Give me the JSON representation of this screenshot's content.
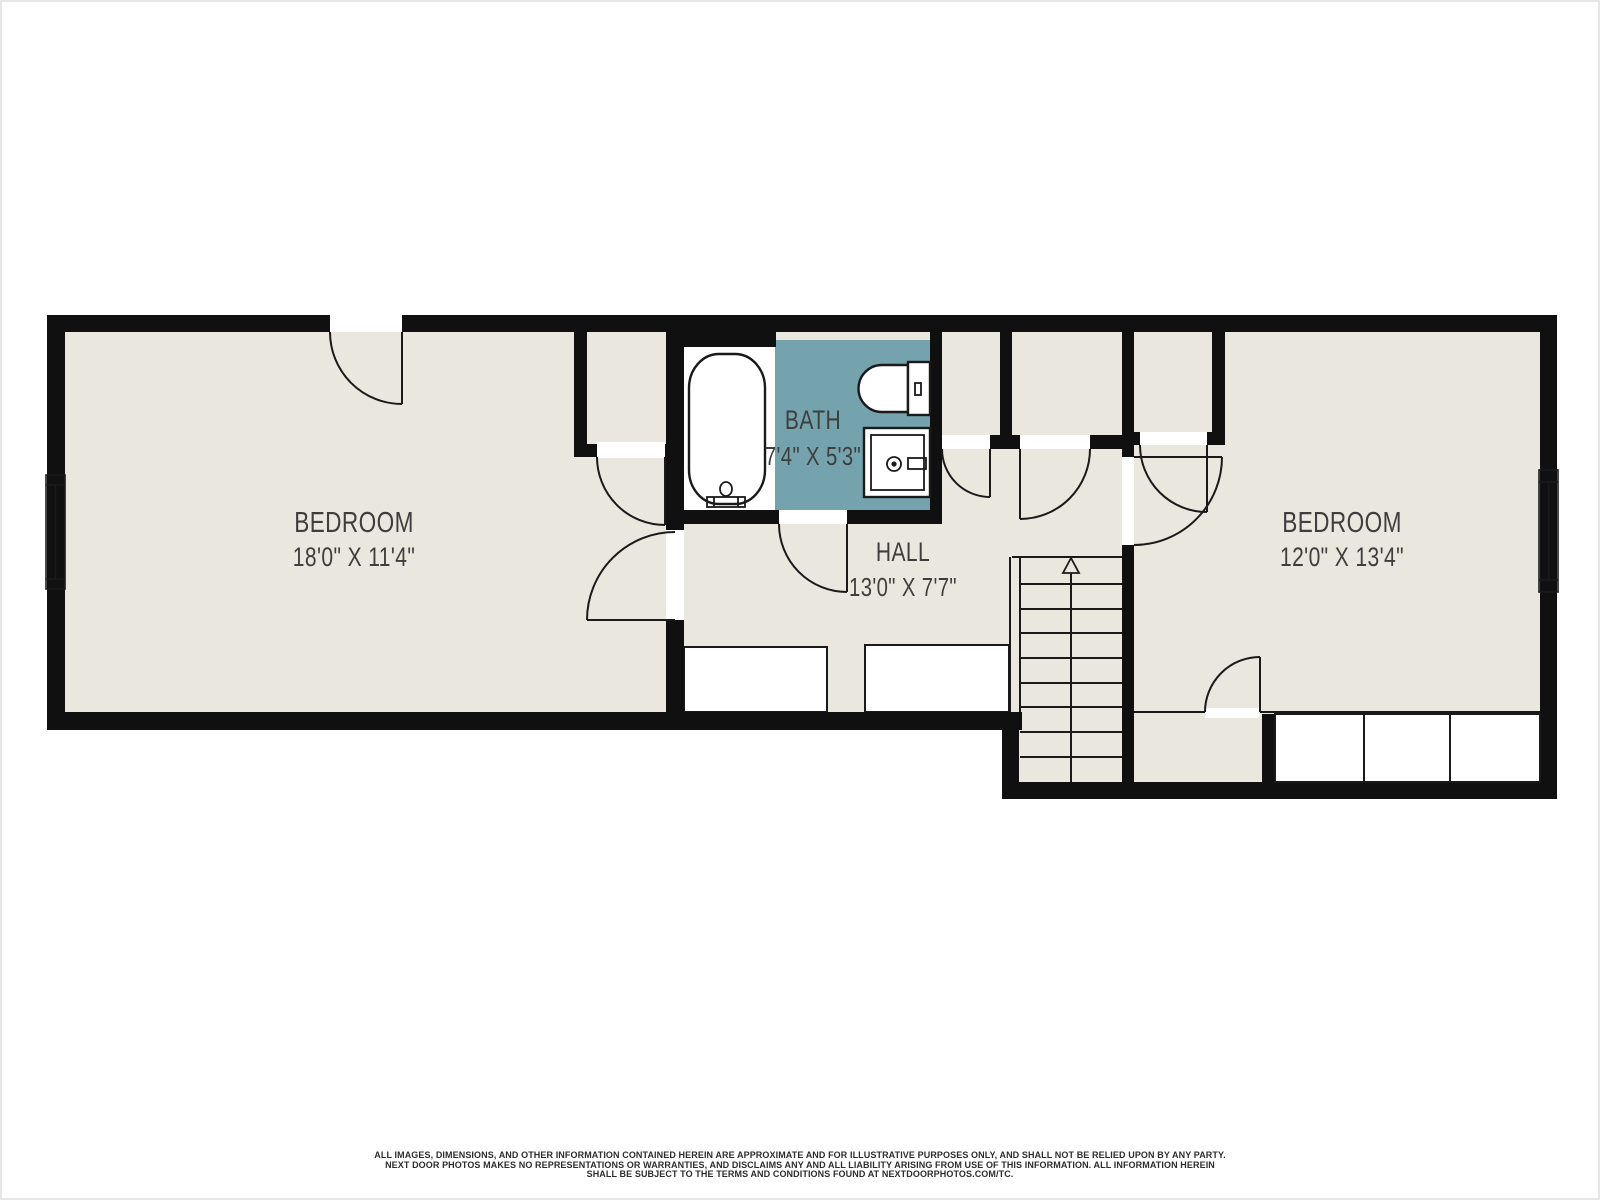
{
  "colors": {
    "wall": "#101010",
    "floor": "#e9e7de",
    "bath_floor": "#74a3ae",
    "line": "#1a1a1a",
    "label": "#3e3e3e",
    "footer_text": "#2d2d2d",
    "page_border": "#e6e6e6"
  },
  "rooms": {
    "bedroom_left": {
      "name": "BEDROOM",
      "dimensions": "18'0\" X 11'4\""
    },
    "bath": {
      "name": "BATH",
      "dimensions": "7'4\" X 5'3\""
    },
    "hall": {
      "name": "HALL",
      "dimensions": "13'0\" X 7'7\""
    },
    "bedroom_right": {
      "name": "BEDROOM",
      "dimensions": "12'0\" X 13'4\""
    }
  },
  "stairs": {
    "direction": "up",
    "steps": 9
  },
  "footer": {
    "line1": "ALL IMAGES, DIMENSIONS, AND OTHER INFORMATION CONTAINED HEREIN ARE APPROXIMATE AND FOR ILLUSTRATIVE PURPOSES ONLY, AND SHALL NOT BE RELIED UPON BY ANY PARTY.",
    "line2": "NEXT DOOR PHOTOS MAKES NO REPRESENTATIONS OR WARRANTIES, AND DISCLAIMS ANY AND ALL LIABILITY ARISING FROM USE OF THIS INFORMATION. ALL INFORMATION HEREIN",
    "line3": "SHALL BE SUBJECT TO THE TERMS AND CONDITIONS FOUND AT NEXTDOORPHOTOS.COM/TC."
  }
}
